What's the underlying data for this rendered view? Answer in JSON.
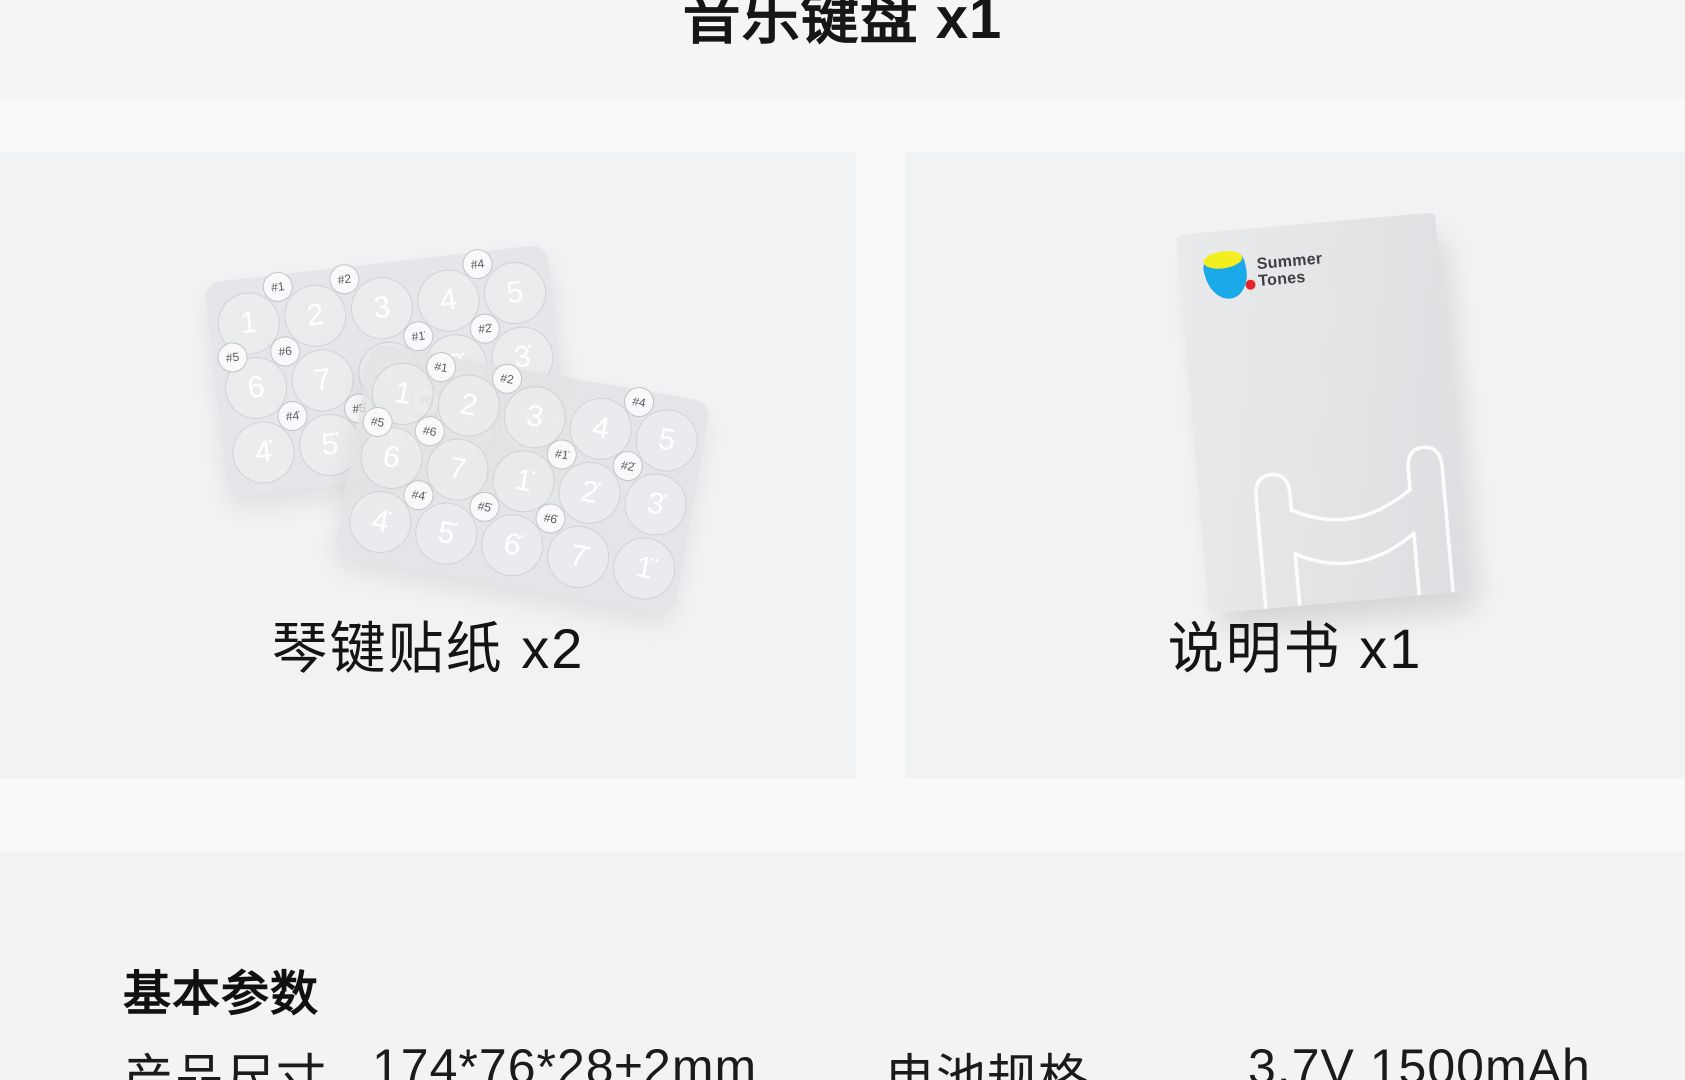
{
  "page": {
    "title": "音乐键盘 x1"
  },
  "items": [
    {
      "caption": "琴键贴纸 x2"
    },
    {
      "caption": "说明书 x1"
    }
  ],
  "manual": {
    "brand_line1": "Summer",
    "brand_line2": "Tones"
  },
  "sticker_sheet": {
    "big_keys": [
      "1",
      "2",
      "3",
      "4",
      "5",
      "6",
      "7",
      "1̇",
      "2̇",
      "3̇",
      "4̇",
      "5̇",
      "6̇",
      "7̇",
      "1̈"
    ],
    "sharp_keys": [
      "#1",
      "#2",
      "#4",
      "#5",
      "#6",
      "#1̇",
      "#2̇",
      "#4̇",
      "#5̇",
      "#6̇"
    ]
  },
  "specs": {
    "heading": "基本参数",
    "rows": [
      {
        "label": "产品尺寸",
        "value": "174*76*28±2mm"
      },
      {
        "label": "电池规格",
        "value": "3.7V 1500mAh"
      }
    ]
  },
  "colors": {
    "brand_blue": "#1AA9E9",
    "brand_yellow": "#F3EE1F",
    "brand_red": "#E5252B",
    "card_gray": "#F1F2F3",
    "text_dark": "#161617"
  }
}
